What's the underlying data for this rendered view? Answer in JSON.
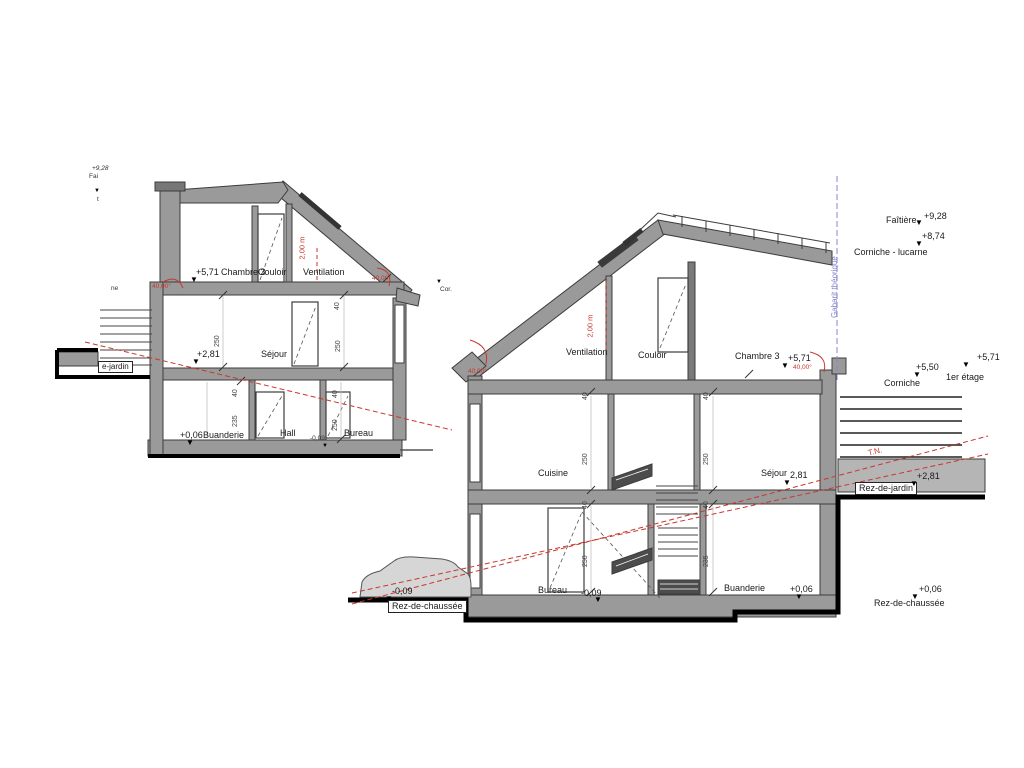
{
  "glyph": {
    "marker": "▼"
  },
  "left": {
    "rooms": {
      "chambre3": "Chambre 3",
      "couloir": "Couloir",
      "ventilation": "Ventilation",
      "sejour": "Séjour",
      "buanderie": "Buanderie",
      "hall": "Hall",
      "bureau": "Bureau"
    },
    "levels": {
      "v571": "+5,71",
      "v281": "+2,81",
      "v006": "+0,06",
      "v009": "-0,09"
    },
    "misc": {
      "top_value": "+9,28",
      "fai": "Fai",
      "t": "t",
      "ne": "ne",
      "cor": "Cor.",
      "jardin": "e-jardin"
    },
    "red": {
      "angle": "40,00°",
      "height": "2,00 m"
    }
  },
  "right": {
    "rooms": {
      "ventilation": "Ventilation",
      "couloir": "Couloir",
      "chambre3": "Chambre 3",
      "cuisine": "Cuisine",
      "sejour": "Séjour",
      "bureau": "Bureau",
      "buanderie": "Buanderie"
    },
    "levels": {
      "faitiere": "Faîtière",
      "v928": "+9,28",
      "corniche_lucarne": "Corniche - lucarne",
      "v874": "+8,74",
      "v550": "+5,50",
      "corniche": "Corniche",
      "v571": "+5,71",
      "etage1": "1er étage",
      "sejour_v": "2,81",
      "v281": "+2,81",
      "jardin": "Rez-de-jardin",
      "v009": "-0,09",
      "v006": "+0,06",
      "rdc": "Rez-de-chaussée"
    },
    "red": {
      "angle": "40,00°",
      "height": "2,00 m",
      "tn": "T.N."
    },
    "blue": {
      "gabarit": "Gabarit théorique"
    }
  },
  "dims": {
    "d250": "250",
    "d40": "40",
    "d235": "235"
  },
  "colors": {
    "wall": "#9a9a9a",
    "dark": "#4c4c4c",
    "red": "#c8372d",
    "blue": "#8585cf"
  }
}
